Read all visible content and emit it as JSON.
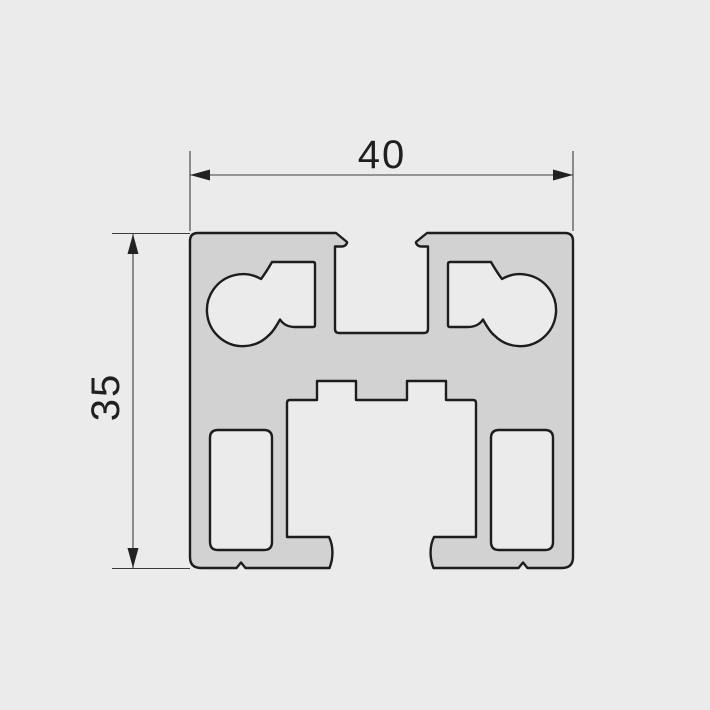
{
  "diagram": {
    "type": "technical-drawing",
    "subject": "aluminum-extrusion-profile-cross-section",
    "dimensions": {
      "width": {
        "label": "40"
      },
      "height": {
        "label": "35"
      }
    }
  },
  "colors": {
    "background": "#ebebeb",
    "profile_fill": "#d2d2d2",
    "hole_fill": "#ebebeb",
    "outline": "#1d1d1b",
    "dimension_lines": "#3c3c3c",
    "label_text": "#1f1f1f"
  }
}
